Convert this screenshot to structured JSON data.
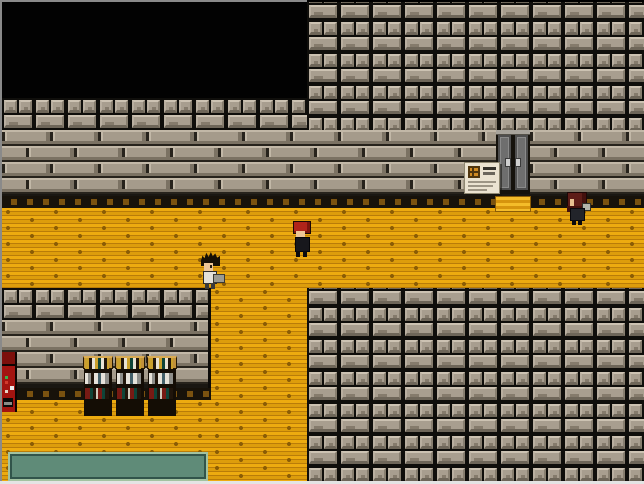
{
  "scene": {
    "title": "Pixel RPG interior",
    "description": "Top-down retro RPG interior: stone-brick walls and grey ceiling-tile blocks surrounding an orange wooden-plank hallway with a dark void room top-left, a grey double door with a notice board, three bookshelves, a red vending machine, a green table and three characters."
  },
  "palette": {
    "void": "#020202",
    "grout": "#0f0e0b",
    "tile_face": "#a89e8f",
    "tile_hl": "#ccc2b2",
    "tile_sh": "#6e6659",
    "tile_mark": "#857b6c",
    "brick_face": "#a59b8b",
    "brick_hl": "#c2b8a7",
    "brick_sh": "#7b7263",
    "brick_joint": "#27231c",
    "baseboard": "#17120a",
    "baseboard_dash": "#7a5210",
    "floor": "#e9a70e",
    "floor_line": "#b97c08",
    "floor_dash": "#8a5c05",
    "mat_light": "#f4bc2a",
    "mat_dark": "#d6940e",
    "door_frame": "#15120c",
    "door_panel": "#6e6e6e",
    "door_panel_line": "#8a8a8a",
    "door_lintel": "#a8a49c",
    "door_handle": "#cfcfcf",
    "sign_bg": "#ebe3d1",
    "sign_icon": "#d08a22",
    "sign_icon_grid": "#4f350e",
    "sign_text_dark": "#35322c",
    "sign_text_light": "#9d9585",
    "shelf_wood": "#b8862e",
    "shelf_frame": "#140d05",
    "machine_red": "#a31410",
    "machine_dark_red": "#7c0f0b",
    "table_fill": "#5f8b78",
    "table_frame_light": "#a2c2a0",
    "table_frame_dark": "#31544a",
    "skin": "#edc697",
    "hair_red": "#b0241a",
    "hair_black": "#161006",
    "hair_maroon": "#5e1d18",
    "shirt_white": "#e3e1da",
    "outfit_dark": "#17171c"
  },
  "entities": {
    "door": {
      "name": "Double door",
      "x": 496,
      "y": 130,
      "w": 34,
      "h": 64
    },
    "doormat": {
      "name": "Yellow door mat",
      "x": 495,
      "y": 196,
      "w": 36,
      "h": 16
    },
    "sign": {
      "name": "Notice board",
      "x": 464,
      "y": 162,
      "w": 36,
      "h": 32
    },
    "bookshelf_1": {
      "name": "Bookshelf",
      "x": 83,
      "y": 356,
      "w": 30,
      "h": 60
    },
    "bookshelf_2": {
      "name": "Bookshelf",
      "x": 115,
      "y": 356,
      "w": 30,
      "h": 60
    },
    "bookshelf_3": {
      "name": "Bookshelf",
      "x": 147,
      "y": 356,
      "w": 30,
      "h": 60
    },
    "vending_machine": {
      "name": "Red vending machine",
      "x": 2,
      "y": 352,
      "w": 15,
      "h": 60
    },
    "table": {
      "name": "Green table",
      "x": 8,
      "y": 452,
      "w": 200,
      "h": 29
    },
    "npc_spiky": {
      "name": "Character with spiky black hair",
      "x": 199,
      "y": 252,
      "w": 25,
      "h": 38
    },
    "npc_red": {
      "name": "Character with red hair",
      "x": 291,
      "y": 221,
      "w": 21,
      "h": 37
    },
    "npc_long": {
      "name": "Character with long dark-red hair",
      "x": 565,
      "y": 192,
      "w": 25,
      "h": 35
    }
  }
}
